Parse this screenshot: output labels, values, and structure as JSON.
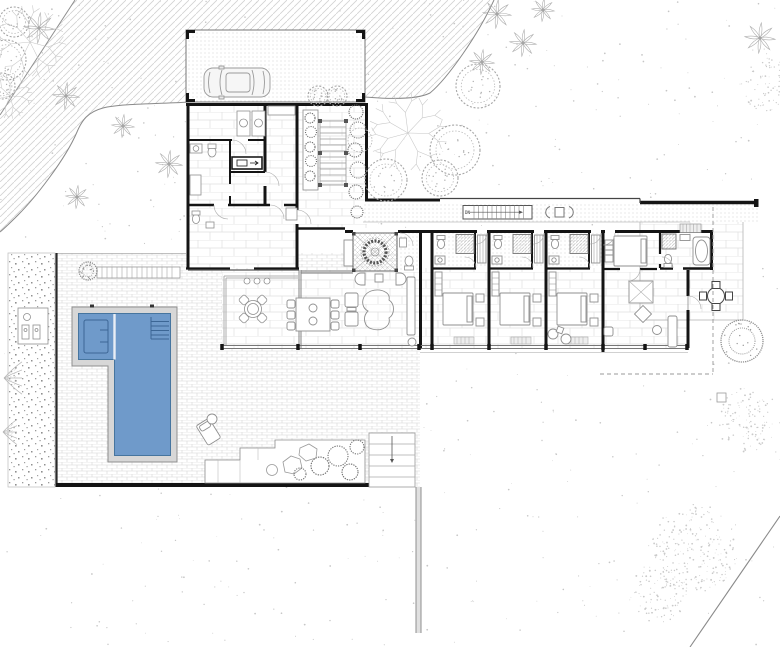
{
  "drawing": {
    "kind": "residential-site-plan",
    "labels": {
      "stair_direction": "DN"
    },
    "palette": {
      "pool_water": "#6f9aca",
      "pool_edge": "#46759f",
      "coping": "#d7d7d7",
      "wall": "#141414",
      "line_light": "#cdcdcd",
      "line_mid": "#8f8f8f",
      "paper": "#ffffff"
    },
    "features": {
      "bedrooms_drawn": 4,
      "pool_shape": "L",
      "carport_cars": 1
    },
    "trees": [
      {
        "type": "branchy",
        "x": 30,
        "y": 42,
        "r": 42
      },
      {
        "type": "canopy",
        "x": 14,
        "y": 22,
        "r": 15
      },
      {
        "type": "canopy",
        "x": 6,
        "y": 60,
        "r": 20
      },
      {
        "type": "branchy",
        "x": 10,
        "y": 96,
        "r": 26
      },
      {
        "type": "palm",
        "x": 39,
        "y": 28,
        "r": 16
      },
      {
        "type": "canopy",
        "x": 2,
        "y": 86,
        "r": 13
      },
      {
        "type": "palm",
        "x": 66,
        "y": 96,
        "r": 14
      },
      {
        "type": "palm",
        "x": 123,
        "y": 126,
        "r": 12
      },
      {
        "type": "palm",
        "x": 169,
        "y": 164,
        "r": 14
      },
      {
        "type": "palm",
        "x": 77,
        "y": 197,
        "r": 12
      },
      {
        "type": "canopy",
        "x": 318,
        "y": 96,
        "r": 10
      },
      {
        "type": "canopy",
        "x": 337,
        "y": 96,
        "r": 10
      },
      {
        "type": "branchy",
        "x": 408,
        "y": 133,
        "r": 46
      },
      {
        "type": "canopy",
        "x": 478,
        "y": 86,
        "r": 22
      },
      {
        "type": "canopy",
        "x": 455,
        "y": 150,
        "r": 25
      },
      {
        "type": "canopy",
        "x": 440,
        "y": 178,
        "r": 18
      },
      {
        "type": "canopy",
        "x": 386,
        "y": 180,
        "r": 21
      },
      {
        "type": "palm",
        "x": 497,
        "y": 14,
        "r": 15
      },
      {
        "type": "palm",
        "x": 523,
        "y": 43,
        "r": 14
      },
      {
        "type": "palm",
        "x": 543,
        "y": 10,
        "r": 12
      },
      {
        "type": "palm",
        "x": 482,
        "y": 62,
        "r": 13
      },
      {
        "type": "palm",
        "x": 760,
        "y": 38,
        "r": 16
      },
      {
        "type": "stipple",
        "x": 766,
        "y": 84,
        "r": 27
      },
      {
        "type": "scrub",
        "x": 742,
        "y": 341,
        "r": 21
      },
      {
        "type": "stipple",
        "x": 748,
        "y": 420,
        "r": 32
      },
      {
        "type": "stipple",
        "x": 695,
        "y": 548,
        "r": 44
      },
      {
        "type": "stipple",
        "x": 658,
        "y": 592,
        "r": 30
      },
      {
        "type": "fern",
        "x": 4,
        "y": 378,
        "r": 18
      },
      {
        "type": "fern",
        "x": 3,
        "y": 432,
        "r": 14
      },
      {
        "type": "scrub",
        "x": 88,
        "y": 271,
        "r": 9
      }
    ]
  }
}
